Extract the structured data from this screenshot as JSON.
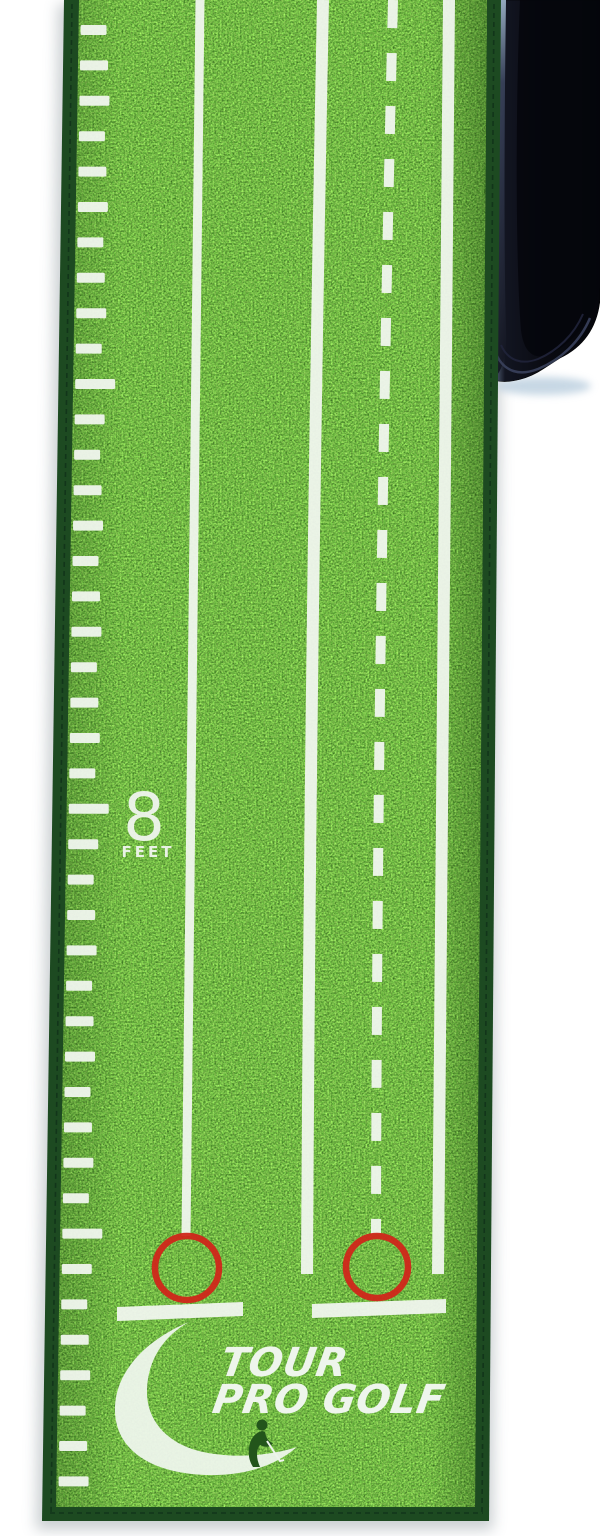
{
  "scene": {
    "background_color": "#ffffff",
    "subject": "Tour Pro Golf putting green mat with black ball-return tray",
    "view": "top-down product photo"
  },
  "mat": {
    "grass_colors": {
      "base": "#5fa23a",
      "light": "#a5d862",
      "dark": "#1e5a14"
    },
    "binding_color": "#1d4a21",
    "stitch_color": "#12351a",
    "line_color": "#f0f5ee",
    "marker": {
      "value": "8",
      "unit": "FEET"
    },
    "ruler": {
      "tick_count": 42,
      "first_y": 30,
      "spacing": 35.4,
      "foot_tick_indices": [
        10,
        22,
        34
      ],
      "short_length": 26,
      "long_length": 38
    },
    "lanes": {
      "count": 2,
      "left_boundary_style": "solid",
      "divider_style": "solid",
      "center_guide_style": "dashed",
      "right_boundary_style": "solid",
      "target_circle_color": "#d0261a",
      "target_circle_count": 2,
      "tee_line_count": 2
    },
    "logo": {
      "line1": "TOUR",
      "line2": "PRO GOLF",
      "icon": "crescent-golfer",
      "color": "#eef5ec"
    }
  },
  "tray": {
    "label": "ball-return-tray",
    "color": "#0b0c14"
  }
}
